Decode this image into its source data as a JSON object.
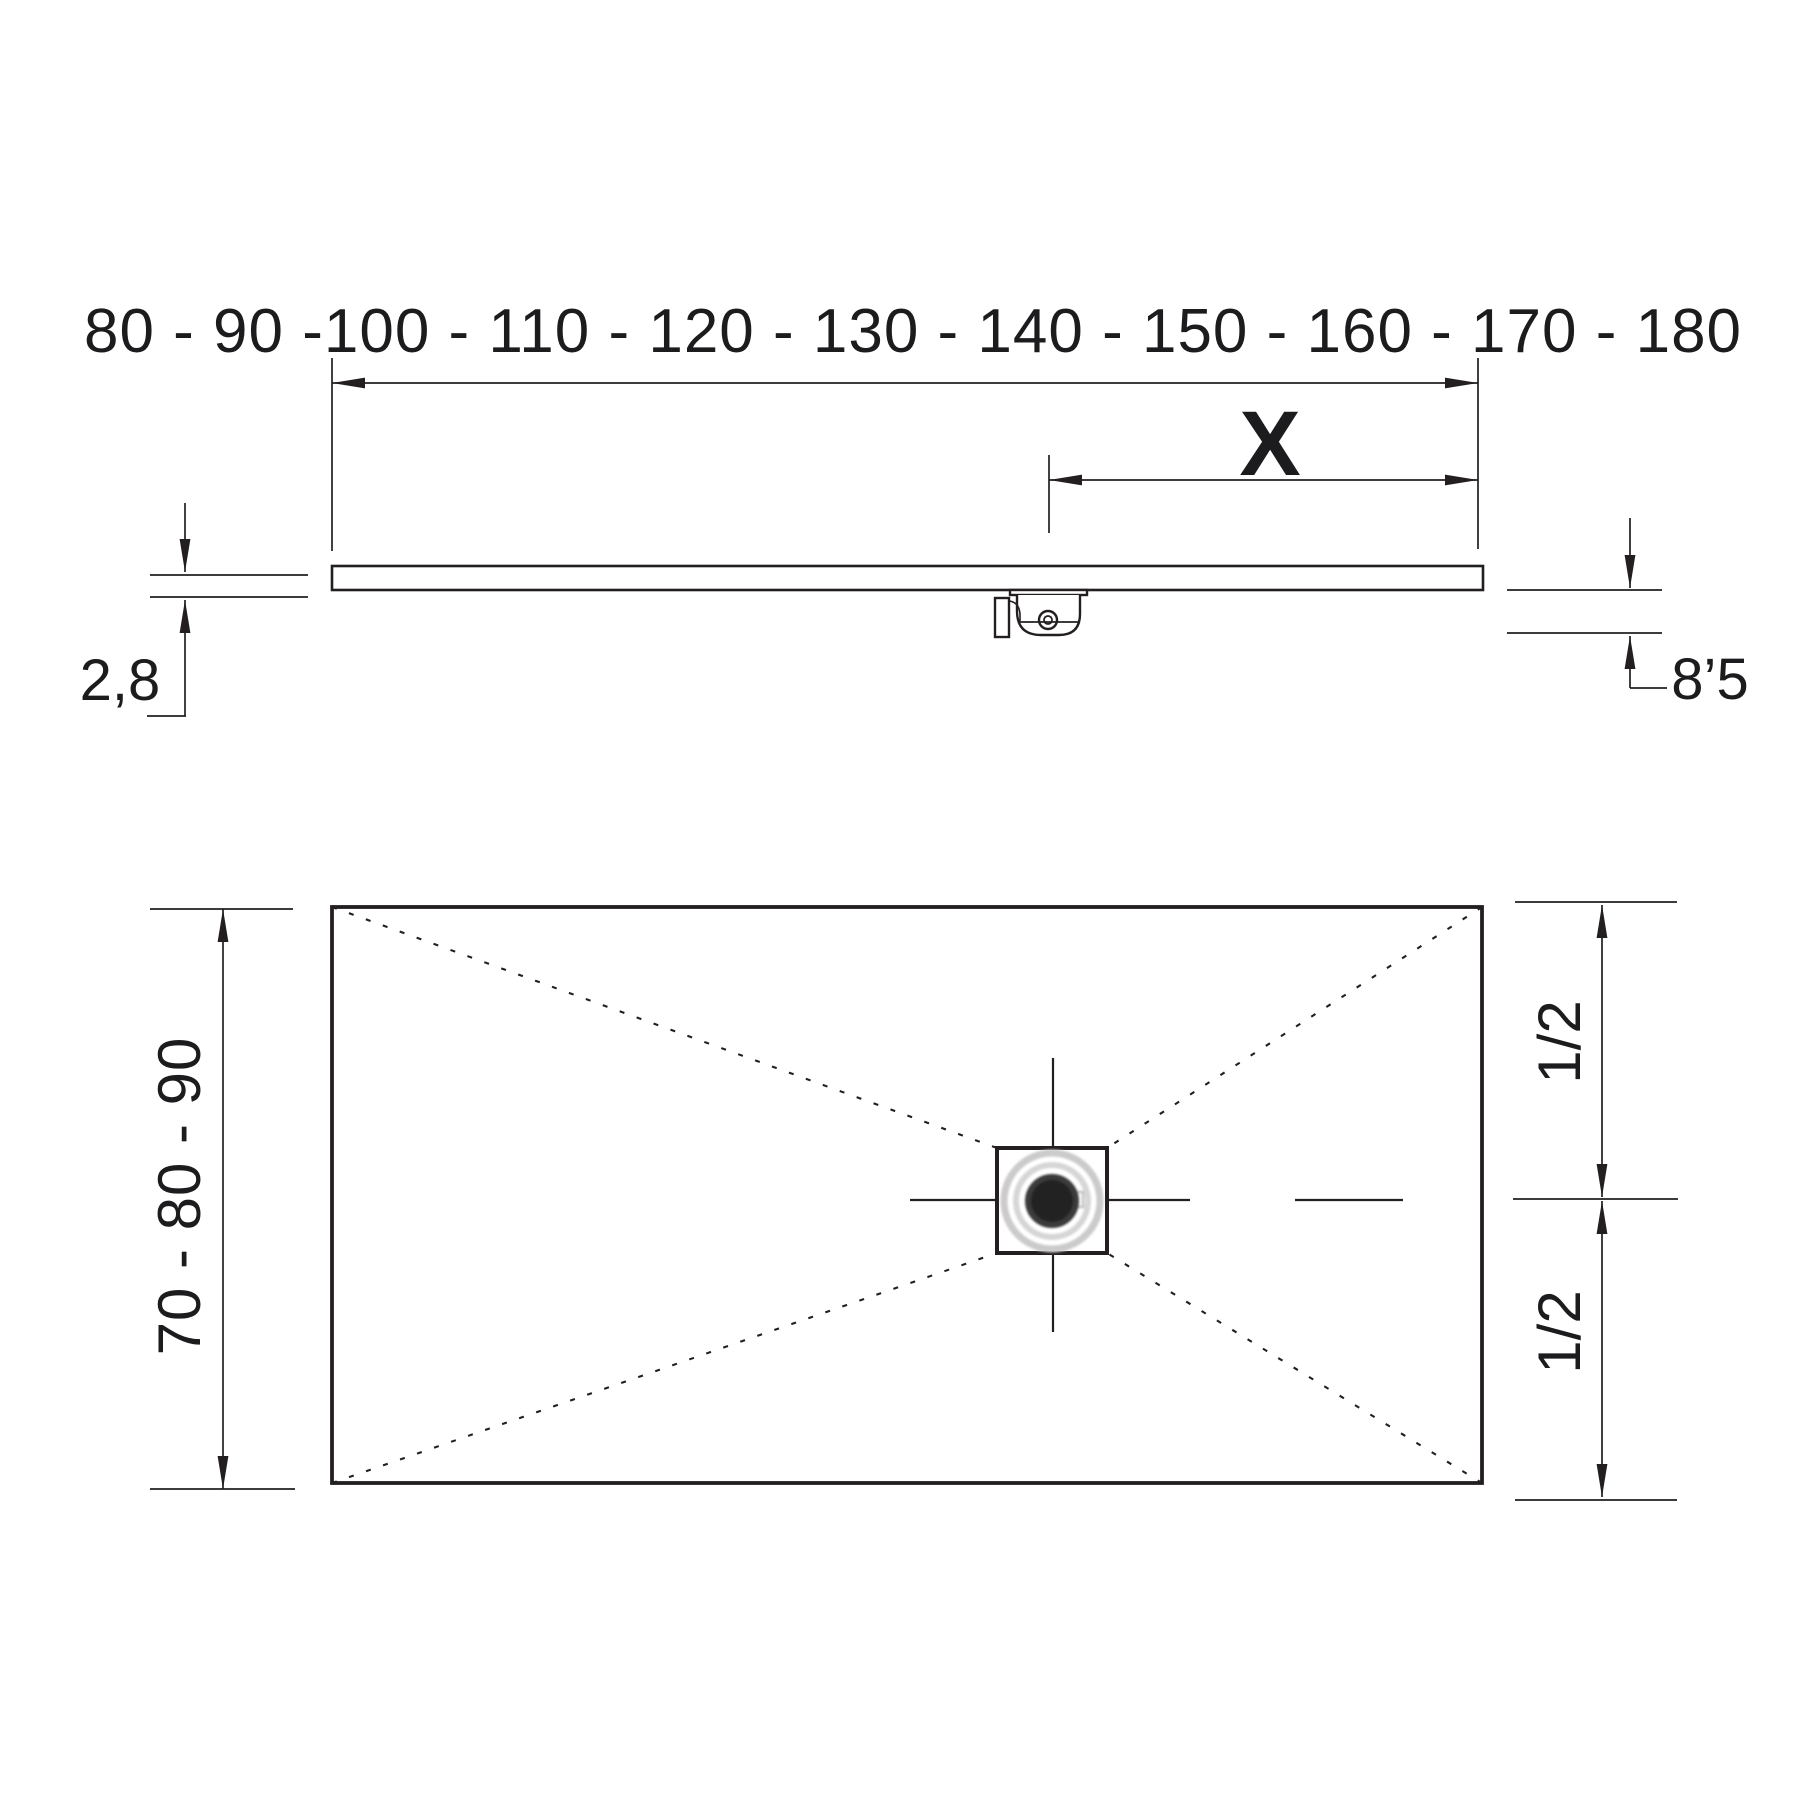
{
  "colors": {
    "background": "#ffffff",
    "ink": "#231f20",
    "drain_center": "#2b2b2b",
    "drain_ring": "#cccccc"
  },
  "side_view": {
    "width_range_label": "80 - 90 -100 - 110 - 120 - 130 - 140 - 150 - 160 - 170 - 180",
    "drain_offset_label": "X",
    "tray_thickness_label": "2,8",
    "total_height_label": "8’5"
  },
  "plan_view": {
    "depth_range_label": "70 - 80 - 90",
    "half_width_top_label": "1/2",
    "half_width_bottom_label": "1/2"
  }
}
